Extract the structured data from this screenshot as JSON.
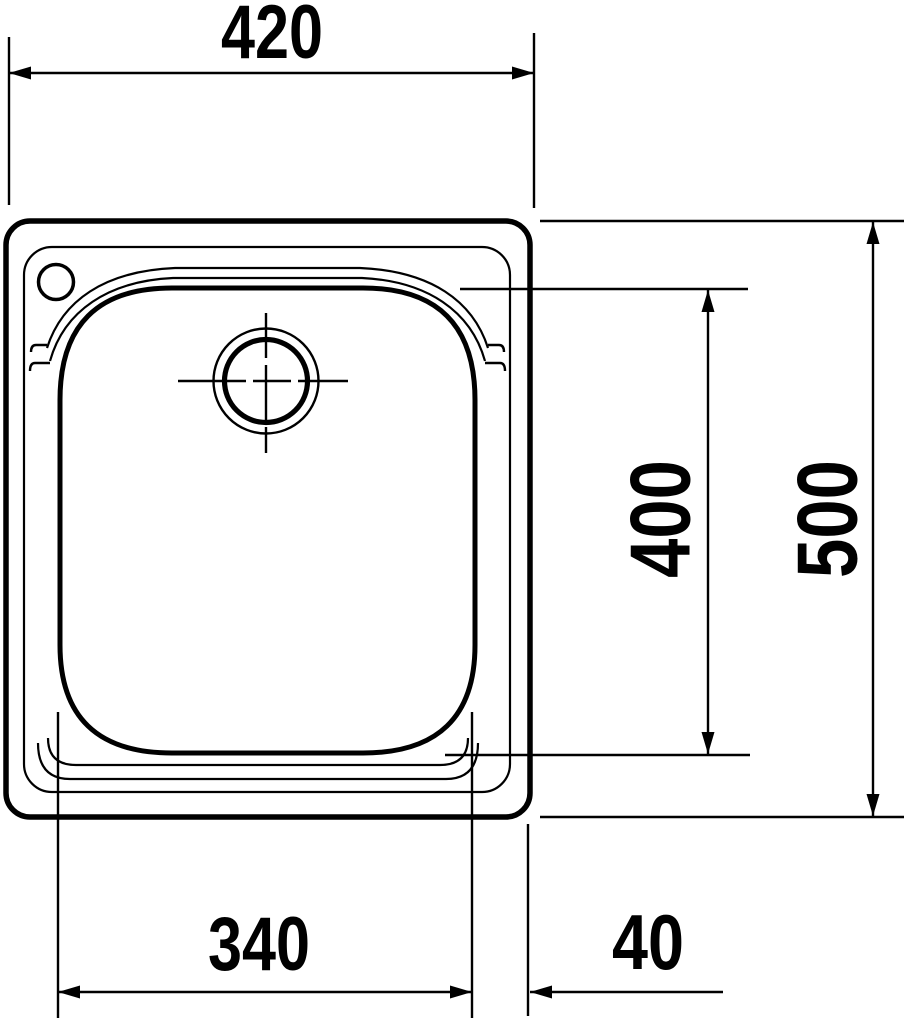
{
  "page": {
    "background_color": "#ffffff",
    "line_color": "#000000"
  },
  "drawing": {
    "type": "technical-drawing",
    "subject": "kitchen sink single bowl top view with dimensions",
    "dimensions": {
      "overall_width_mm": "420",
      "overall_depth_mm": "500",
      "bowl_depth_mm": "400",
      "bowl_width_mm": "340",
      "bowl_edge_offset_mm": "40"
    }
  }
}
